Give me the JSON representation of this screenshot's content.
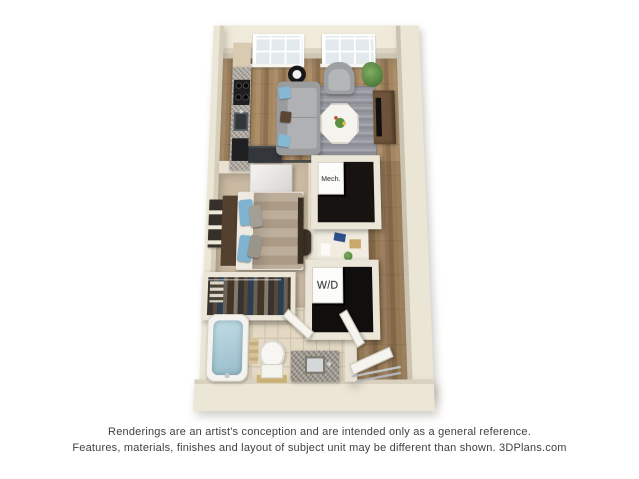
{
  "floorplan": {
    "labels": {
      "mech_closet": "Mech.",
      "washer_dryer": "W/D"
    }
  },
  "disclaimer": {
    "line1": "Renderings are an artist's conception and are intended only as a general reference.",
    "line2": "Features, materials, finishes and layout of subject unit may be different than shown. 3DPlans.com"
  },
  "colors": {
    "background": "#ffffff",
    "wall": "#e9e2d2",
    "wood_floor": "#9c7e5c",
    "bedroom_carpet": "#cbbaa3",
    "bathroom_tile": "#e3d9c4",
    "area_rug": "#97979f",
    "sofa": "#a3a4a6",
    "accent_pillows": "#85b9d3",
    "bed_comforter": "#b4a28d",
    "granite_counter": "#a8a29a",
    "closet_interior": "#161310",
    "disclaimer_text": "#414141"
  }
}
